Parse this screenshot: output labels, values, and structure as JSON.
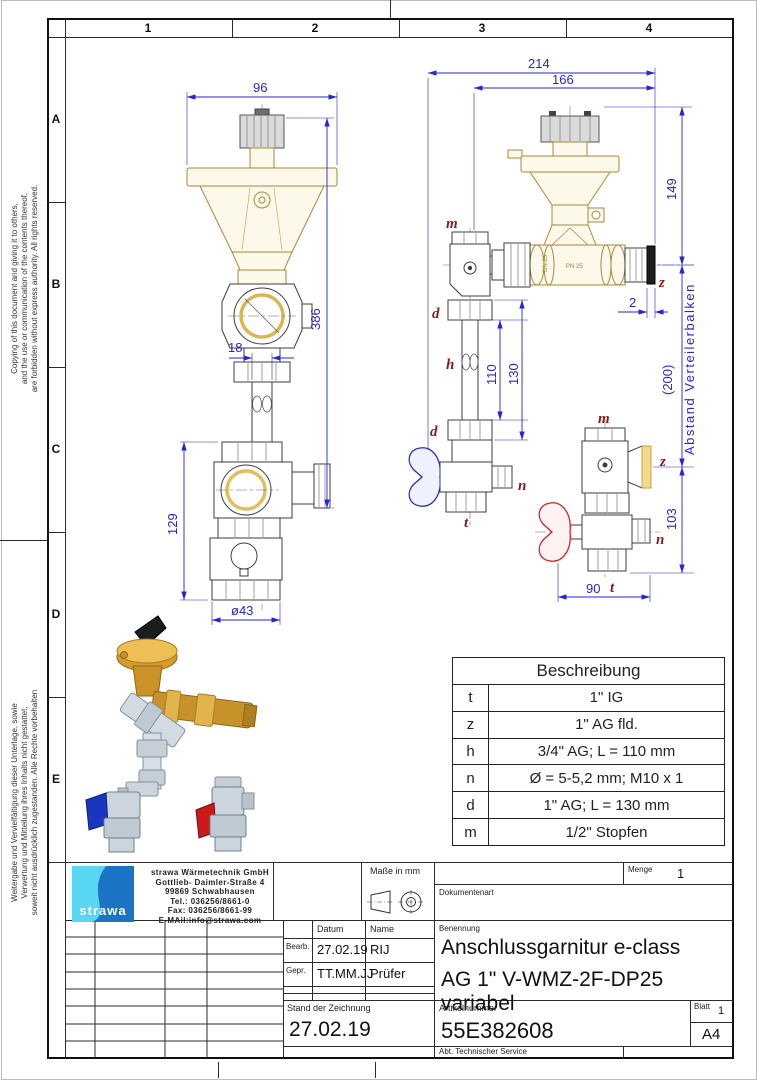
{
  "page": {
    "columns": [
      "1",
      "2",
      "3",
      "4"
    ],
    "rows": [
      "A",
      "B",
      "C",
      "D",
      "E"
    ],
    "copyright_en_lines": [
      "Copying of this document and giving it to others,",
      "and the use or communication of the contents thereof,",
      "are forbidden without express authority. All rights reserved."
    ],
    "copyright_de_lines": [
      "Weitergabe und Vervielfältigung dieser Unterlage, sowie",
      "Verwertung und Mitteilung ihres Inhalts nicht gestattet,",
      "soweit nicht ausdrücklich zugestanden. Alle Rechte vorbehalten"
    ]
  },
  "drawing": {
    "front_view": {
      "dim_width": "96",
      "dim_height": "386",
      "dim_pipe": "18",
      "dim_lower": "129",
      "dim_dia": "ø43"
    },
    "side_view": {
      "dim_overall": "214",
      "dim_inner": "166",
      "dim_height": "149",
      "dim_gap": "2",
      "dim_pipe": "110",
      "dim_pipe_overall": "130",
      "dim_detail_h": "103",
      "dim_detail_w": "90",
      "dim_distance": "(200)",
      "distance_label": "Abstand Verteilerbalken",
      "label_m": "m",
      "label_z": "z",
      "label_d": "d",
      "label_h": "h",
      "label_n": "n",
      "label_t": "t",
      "body_mark_dn": "DN 25",
      "body_mark_pn": "PN 25"
    }
  },
  "description_table": {
    "title": "Beschreibung",
    "rows": [
      {
        "key": "t",
        "value": "1\" IG"
      },
      {
        "key": "z",
        "value": "1\" AG fld."
      },
      {
        "key": "h",
        "value": "3/4\" AG; L = 110 mm"
      },
      {
        "key": "n",
        "value": "Ø = 5-5,2 mm; M10 x 1"
      },
      {
        "key": "d",
        "value": "1\" AG; L = 130 mm"
      },
      {
        "key": "m",
        "value": "1/2\" Stopfen"
      }
    ]
  },
  "title_block": {
    "company": {
      "logo_text": "strawa",
      "name": "strawa Wärmetechnik GmbH",
      "address1": "Gottlieb- Daimler-Straße 4",
      "address2": "99869 Schwabhausen",
      "tel": "Tel.: 036256/8661-0",
      "fax": "Fax: 036256/8661-99",
      "email": "E-MAil:info@strawa.com"
    },
    "units_label": "Maße in mm",
    "menge_label": "Menge",
    "menge_value": "1",
    "dokumentenart_label": "Dokumentenart",
    "datum_label": "Datum",
    "name_label": "Name",
    "bearb_label": "Bearb.",
    "bearb_date": "27.02.19",
    "bearb_name": "RIJ",
    "gepr_label": "Gepr.",
    "gepr_date": "TT.MM.JJ",
    "gepr_name": "Prüfer",
    "benennung_label": "Benennung",
    "benennung_line1": "Anschlussgarnitur e-class",
    "benennung_line2": "AG 1\" V-WMZ-2F-DP25 variabel",
    "stand_label": "Stand der Zeichnung",
    "stand_value": "27.02.19",
    "artikel_label": "Artikelnummer",
    "artikel_value": "55E382608",
    "blatt_label": "Blatt",
    "blatt_value": "1",
    "format_value": "A4",
    "abt_value": "Abt. Technischer Service"
  },
  "colors": {
    "dimension": "#2424d9",
    "label": "#8a1a1a",
    "brass": "#b9983f",
    "blue_handle": "#2a2ad4",
    "red_handle": "#d92121",
    "logo_light": "#59d7f2",
    "logo_dark": "#1b74c5"
  }
}
